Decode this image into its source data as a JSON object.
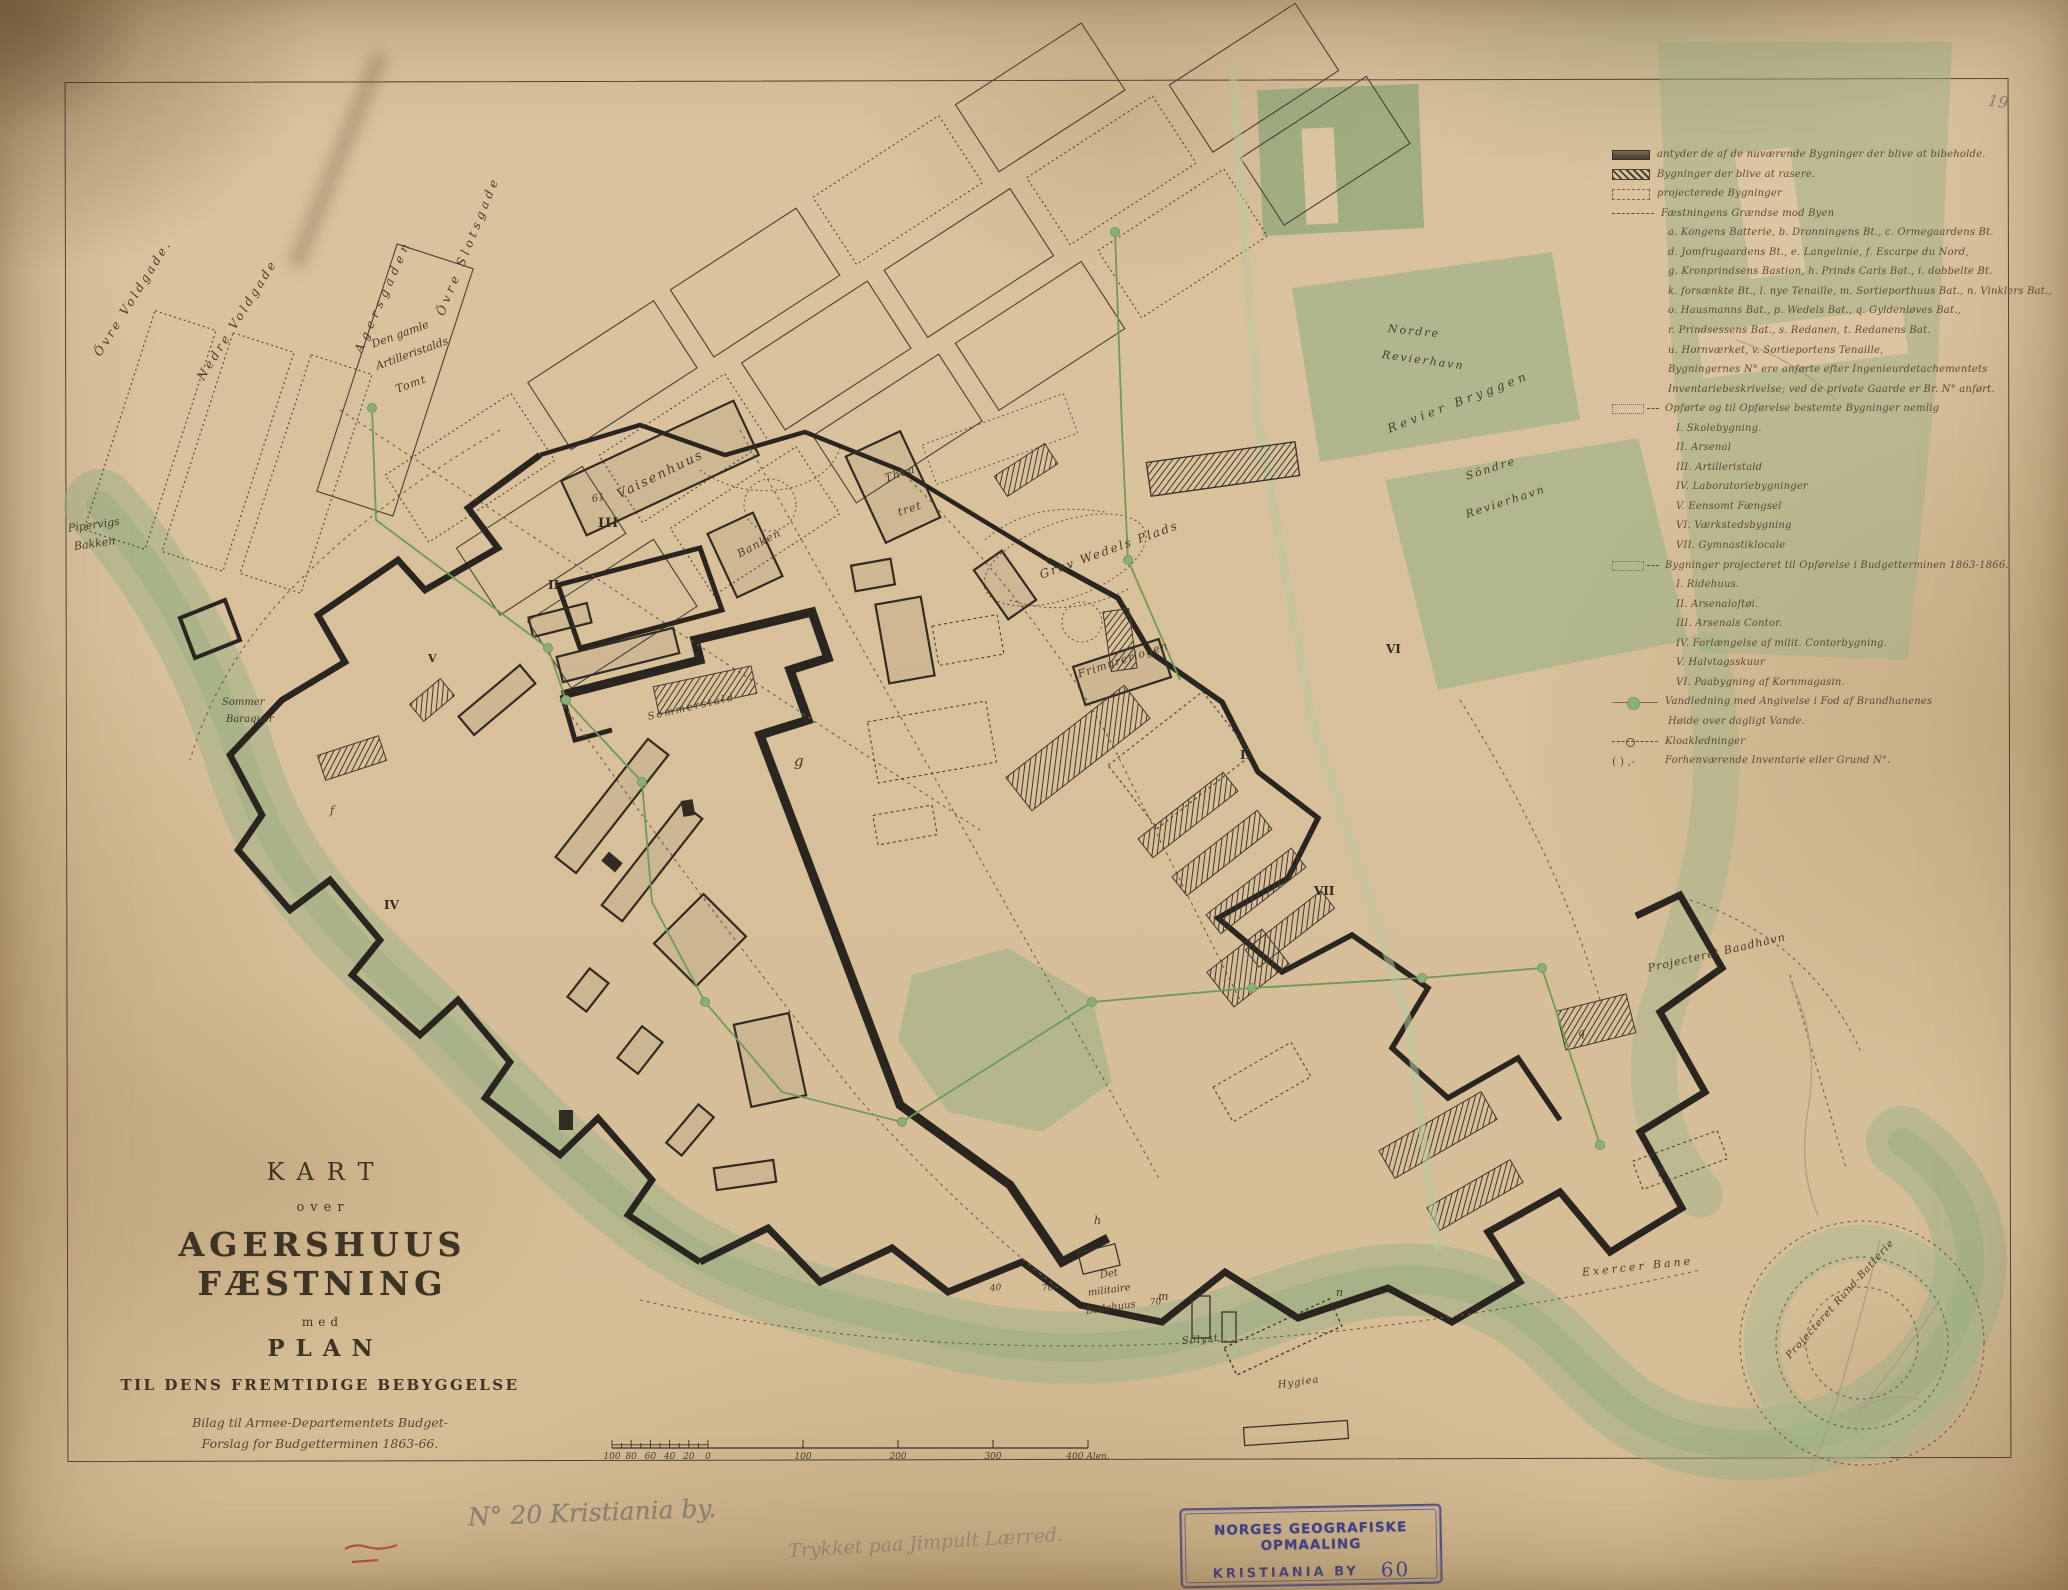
{
  "page": {
    "number": "19"
  },
  "colors": {
    "paper": "#dac39e",
    "water_green": "#9cb287",
    "wall_ink": "#2b2520",
    "stamp_blue": "#3d3f8e",
    "pencil_grey": "#8a8274",
    "red_crayon": "#b8412f"
  },
  "title_block": {
    "kart": "KART",
    "over": "over",
    "main": "AGERSHUUS FÆSTNING",
    "med": "med",
    "plan": "PLAN",
    "sub": "TIL DENS FREMTIDIGE BEBYGGELSE",
    "bilag1": "Bilag til Armee-Departementets Budget-",
    "bilag2": "Forslag for Budgetterminen 1863-66."
  },
  "legend": {
    "items": [
      {
        "sym": "bar-solid",
        "ind": 0,
        "text": "antyder de af de nuværende Bygninger der blive at bibeholde."
      },
      {
        "sym": "bar-hatch",
        "ind": 0,
        "text": "Bygninger der blive at rasere."
      },
      {
        "sym": "bar-open",
        "ind": 0,
        "text": "projecterede Bygninger"
      },
      {
        "sym": "dash",
        "ind": 0,
        "text": "Fæstningens Grændse mod Byen"
      },
      {
        "sym": "none",
        "ind": 1,
        "text": "a. Kongens Batterie, b. Dronningens Bt., c. Ormegaardens Bt."
      },
      {
        "sym": "none",
        "ind": 1,
        "text": "d. Jomfrugaardens Bt., e. Langelinie, f. Escarpe du Nord,"
      },
      {
        "sym": "none",
        "ind": 1,
        "text": "g. Kronprindsens Bastion, h. Prinds Carls Bat., i. dobbelte Bt."
      },
      {
        "sym": "none",
        "ind": 1,
        "text": "k. forsænkte Bt., l. nye Tenaille, m. Sortieporthuus Bat., n. Vinklers Bat.,"
      },
      {
        "sym": "none",
        "ind": 1,
        "text": "o. Hausmanns Bat., p. Wedels Bat., q. Gyldenløves Bat.,"
      },
      {
        "sym": "none",
        "ind": 1,
        "text": "r. Prindsessens Bat., s. Redanen, t. Redanens Bat."
      },
      {
        "sym": "none",
        "ind": 1,
        "text": "u. Hornværket, v. Sortieportens Tenaille,"
      },
      {
        "sym": "none",
        "ind": 1,
        "text": "Bygningernes N° ere anførte efter Ingenieurdetachementets"
      },
      {
        "sym": "none",
        "ind": 1,
        "text": "Inventariebeskrivelse; ved de private Gaarde er Br. N° anført."
      },
      {
        "sym": "bar-open-dash",
        "ind": 0,
        "text": "Opførte og til Opførelse bestemte Bygninger nemlig"
      },
      {
        "sym": "none",
        "ind": 2,
        "text": "I. Skolebygning."
      },
      {
        "sym": "none",
        "ind": 2,
        "text": "II. Arsenal"
      },
      {
        "sym": "none",
        "ind": 2,
        "text": "III. Artilleristald"
      },
      {
        "sym": "none",
        "ind": 2,
        "text": "IV. Laboratoriebygninger"
      },
      {
        "sym": "none",
        "ind": 2,
        "text": "V. Eensomt Fængsel"
      },
      {
        "sym": "none",
        "ind": 2,
        "text": "VI. Værkstedsbygning"
      },
      {
        "sym": "none",
        "ind": 2,
        "text": "VII. Gymnastiklocale"
      },
      {
        "sym": "bar-open-dash",
        "ind": 0,
        "text": "Bygninger projecteret til Opførelse i Budgetterminen 1863-1866."
      },
      {
        "sym": "none",
        "ind": 2,
        "text": "I. Ridehuus."
      },
      {
        "sym": "none",
        "ind": 2,
        "text": "II. Arsenaloftøi."
      },
      {
        "sym": "none",
        "ind": 2,
        "text": "III. Arsenals Contor."
      },
      {
        "sym": "none",
        "ind": 2,
        "text": "IV. Forlængelse af milit. Contorbygning."
      },
      {
        "sym": "none",
        "ind": 2,
        "text": "V. Halvtagsskuur"
      },
      {
        "sym": "none",
        "ind": 2,
        "text": "VI. Paabygning af Kornmagasin."
      },
      {
        "sym": "water",
        "ind": 0,
        "text": "Vandledning med Angivelse i Fod af Brandhanenes"
      },
      {
        "sym": "none",
        "ind": 1,
        "text": "Høide over dagligt Vande."
      },
      {
        "sym": "sewer",
        "ind": 0,
        "text": "Kloakledninger"
      },
      {
        "sym": "paren",
        "ind": 0,
        "text": "Forhenværende Inventarie eller Grund N°."
      }
    ]
  },
  "map_labels": [
    {
      "text": "Övre Voldgade.",
      "x": 97,
      "y": 348,
      "rot": -58,
      "fs": 12,
      "ls": 3
    },
    {
      "text": "Nedre Voldgade",
      "x": 200,
      "y": 372,
      "rot": -58,
      "fs": 12,
      "ls": 3
    },
    {
      "text": "Agersgaden",
      "x": 358,
      "y": 345,
      "rot": -66,
      "fs": 12,
      "ls": 5
    },
    {
      "text": "Övre Slotsgade",
      "x": 440,
      "y": 308,
      "rot": -68,
      "fs": 12,
      "ls": 4
    },
    {
      "text": "Den gamle",
      "x": 372,
      "y": 338,
      "rot": -20,
      "fs": 11,
      "ls": 0
    },
    {
      "text": "Artilleristalds",
      "x": 376,
      "y": 360,
      "rot": -20,
      "fs": 11,
      "ls": 0
    },
    {
      "text": "Tomt",
      "x": 396,
      "y": 383,
      "rot": -20,
      "fs": 11,
      "ls": 1
    },
    {
      "text": "Pipervigs",
      "x": 68,
      "y": 522,
      "rot": -8,
      "fs": 11,
      "ls": 0
    },
    {
      "text": "Bakken",
      "x": 74,
      "y": 540,
      "rot": -8,
      "fs": 11,
      "ls": 0
    },
    {
      "text": "Vaisenhuus",
      "x": 618,
      "y": 488,
      "rot": -26,
      "fs": 13,
      "ls": 2
    },
    {
      "text": "Banken",
      "x": 738,
      "y": 548,
      "rot": -28,
      "fs": 11,
      "ls": 1
    },
    {
      "text": "Thea",
      "x": 885,
      "y": 472,
      "rot": -18,
      "fs": 11,
      "ls": 1
    },
    {
      "text": "tret",
      "x": 898,
      "y": 506,
      "rot": -18,
      "fs": 11,
      "ls": 1
    },
    {
      "text": "Grev Wedels Plads",
      "x": 1040,
      "y": 568,
      "rot": -20,
      "fs": 12,
      "ls": 2
    },
    {
      "text": "Frimurerlogen",
      "x": 1078,
      "y": 668,
      "rot": -18,
      "fs": 11,
      "ls": 1
    },
    {
      "text": "Nordre",
      "x": 1388,
      "y": 322,
      "rot": 6,
      "fs": 11,
      "ls": 2
    },
    {
      "text": "Revierhavn",
      "x": 1382,
      "y": 348,
      "rot": 8,
      "fs": 11,
      "ls": 2
    },
    {
      "text": "Revier Bryggen",
      "x": 1388,
      "y": 422,
      "rot": -21,
      "fs": 12,
      "ls": 4
    },
    {
      "text": "Söndre",
      "x": 1466,
      "y": 470,
      "rot": -18,
      "fs": 11,
      "ls": 2
    },
    {
      "text": "Revierhavn",
      "x": 1466,
      "y": 508,
      "rot": -18,
      "fs": 11,
      "ls": 2
    },
    {
      "text": "Projecteret Baadhavn",
      "x": 1648,
      "y": 962,
      "rot": -13,
      "fs": 11,
      "ls": 1
    },
    {
      "text": "Sommer",
      "x": 222,
      "y": 697,
      "rot": 0,
      "fs": 10,
      "ls": 0
    },
    {
      "text": "Baraquer",
      "x": 226,
      "y": 714,
      "rot": 0,
      "fs": 10,
      "ls": 0
    },
    {
      "text": "Sommerstald",
      "x": 648,
      "y": 712,
      "rot": -13,
      "fs": 10,
      "ls": 2
    },
    {
      "text": "Det",
      "x": 1100,
      "y": 1270,
      "rot": -8,
      "fs": 10,
      "ls": 0
    },
    {
      "text": "militaire",
      "x": 1088,
      "y": 1288,
      "rot": -8,
      "fs": 10,
      "ls": 0
    },
    {
      "text": "Badehuus",
      "x": 1086,
      "y": 1306,
      "rot": -8,
      "fs": 10,
      "ls": 0
    },
    {
      "text": "Sölyst",
      "x": 1182,
      "y": 1336,
      "rot": -5,
      "fs": 10,
      "ls": 1
    },
    {
      "text": "Hygiea",
      "x": 1278,
      "y": 1380,
      "rot": -8,
      "fs": 10,
      "ls": 1
    },
    {
      "text": "Exercer Bane",
      "x": 1582,
      "y": 1266,
      "rot": -6,
      "fs": 11,
      "ls": 3
    },
    {
      "text": "Projecteret Rund-Batterie",
      "x": 1788,
      "y": 1352,
      "rot": -48,
      "fs": 10,
      "ls": 1
    },
    {
      "text": "III",
      "x": 598,
      "y": 516,
      "rot": 0,
      "fs": 13,
      "ls": 1,
      "cls": "rom"
    },
    {
      "text": "II",
      "x": 548,
      "y": 578,
      "rot": 0,
      "fs": 12,
      "ls": 0,
      "cls": "rom"
    },
    {
      "text": "IV",
      "x": 384,
      "y": 898,
      "rot": 0,
      "fs": 12,
      "ls": 0,
      "cls": "rom"
    },
    {
      "text": "V",
      "x": 428,
      "y": 652,
      "rot": 0,
      "fs": 11,
      "ls": 0,
      "cls": "rom"
    },
    {
      "text": "VI",
      "x": 1386,
      "y": 642,
      "rot": 0,
      "fs": 12,
      "ls": 0,
      "cls": "rom"
    },
    {
      "text": "VII",
      "x": 1314,
      "y": 884,
      "rot": 0,
      "fs": 12,
      "ls": 0,
      "cls": "rom"
    },
    {
      "text": "I",
      "x": 1240,
      "y": 748,
      "rot": 0,
      "fs": 12,
      "ls": 0,
      "cls": "rom"
    },
    {
      "text": "g",
      "x": 794,
      "y": 752,
      "rot": 0,
      "fs": 15,
      "ls": 0
    },
    {
      "text": "f",
      "x": 330,
      "y": 804,
      "rot": 0,
      "fs": 11,
      "ls": 0
    },
    {
      "text": "m",
      "x": 1158,
      "y": 1290,
      "rot": 0,
      "fs": 11,
      "ls": 0
    },
    {
      "text": "n",
      "x": 1336,
      "y": 1286,
      "rot": 0,
      "fs": 11,
      "ls": 0
    },
    {
      "text": "p",
      "x": 1658,
      "y": 1164,
      "rot": 0,
      "fs": 11,
      "ls": 0
    },
    {
      "text": "q",
      "x": 1578,
      "y": 1026,
      "rot": 0,
      "fs": 11,
      "ls": 0
    },
    {
      "text": "h",
      "x": 1094,
      "y": 1214,
      "rot": 0,
      "fs": 11,
      "ls": 0
    },
    {
      "text": "61",
      "x": 592,
      "y": 494,
      "rot": -10,
      "fs": 10,
      "ls": 0
    },
    {
      "text": "40",
      "x": 990,
      "y": 1284,
      "rot": -5,
      "fs": 9,
      "ls": 0
    },
    {
      "text": "70",
      "x": 1042,
      "y": 1284,
      "rot": -5,
      "fs": 9,
      "ls": 0
    },
    {
      "text": "70",
      "x": 1150,
      "y": 1298,
      "rot": -5,
      "fs": 9,
      "ls": 0
    }
  ],
  "scale_bar": {
    "left": [
      "100",
      "80",
      "60",
      "40",
      "20",
      "0"
    ],
    "right": [
      "100",
      "200",
      "300"
    ],
    "end": "400 Alen."
  },
  "stamp": {
    "line1": "NORGES GEOGRAFISKE OPMAALING",
    "line2": "KRISTIANIA BY",
    "number": "60"
  },
  "annotations": {
    "no20": "N° 20 Kristiania by.",
    "pencil_note": "Trykket paa Jimpult Lærred.",
    "page_number": "19"
  }
}
